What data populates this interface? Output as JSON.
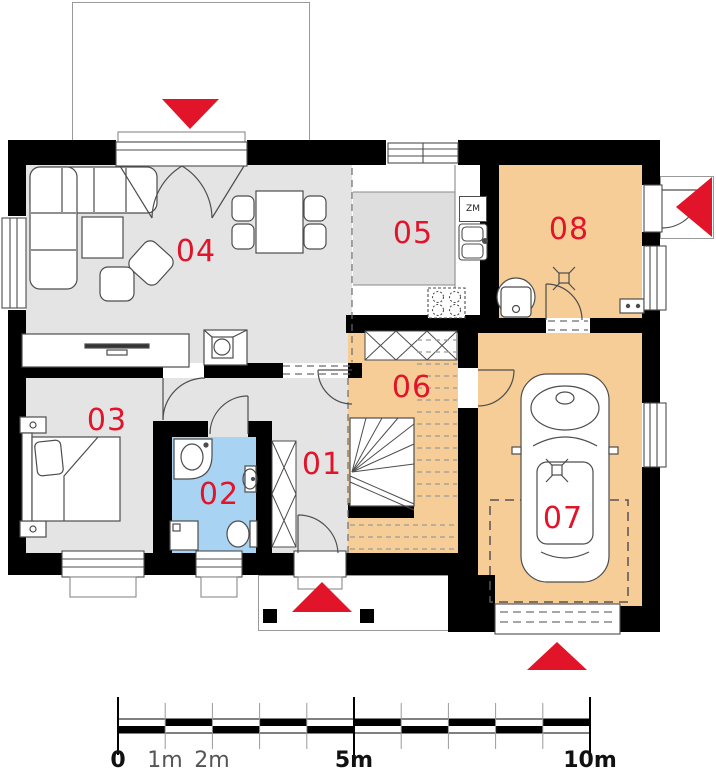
{
  "plan": {
    "type": "house-floor-plan",
    "rooms": {
      "r01": {
        "label": "01",
        "floor_color": "#e4e4e4"
      },
      "r02": {
        "label": "02",
        "floor_color": "#a8d3f2"
      },
      "r03": {
        "label": "03",
        "floor_color": "#e4e4e4"
      },
      "r04": {
        "label": "04",
        "floor_color": "#e4e4e4"
      },
      "r05": {
        "label": "05",
        "floor_color": "#e4e4e4"
      },
      "r06": {
        "label": "06",
        "floor_color": "#f6cd96"
      },
      "r07": {
        "label": "07",
        "floor_color": "#f6cd96"
      },
      "r08": {
        "label": "08",
        "floor_color": "#f6cd96"
      }
    },
    "kitchen": {
      "zm_label": "ZM"
    },
    "entrance_arrows": [
      {
        "location": "terrace-top",
        "direction": "down"
      },
      {
        "location": "front-porch-bottom",
        "direction": "up"
      },
      {
        "location": "garage-bottom",
        "direction": "up"
      },
      {
        "location": "side-porch-right",
        "direction": "left"
      }
    ],
    "colors": {
      "wall": "#000000",
      "floor_gray": "#e4e4e4",
      "floor_orange": "#f6cd96",
      "floor_blue": "#a8d3f2",
      "accent_red": "#e1142a",
      "outline": "#4d4d4d"
    }
  },
  "scale_bar": {
    "labels": [
      {
        "text": "0"
      },
      {
        "text": "1m"
      },
      {
        "text": "2m"
      },
      {
        "text": "5m"
      },
      {
        "text": "10m"
      }
    ]
  }
}
